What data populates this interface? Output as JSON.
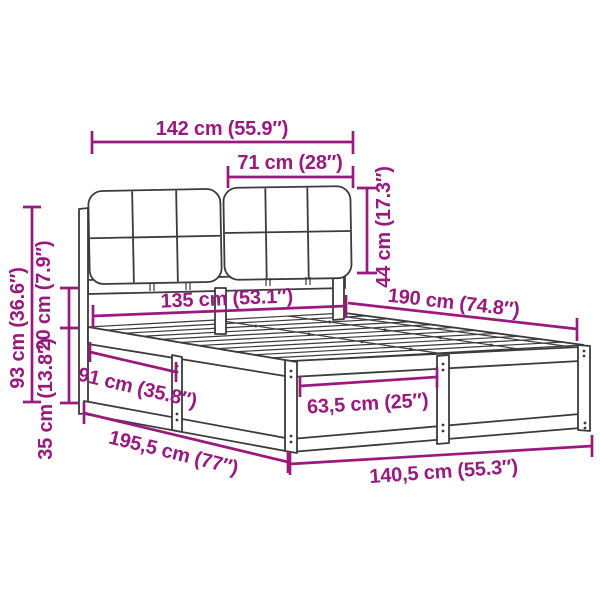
{
  "diagram": {
    "title": "bed-frame-with-upholstered-headboard-dimension-diagram",
    "colors": {
      "dimension": "#991a7e",
      "outline": "#3b3b3b",
      "background": "#ffffff"
    },
    "labels": {
      "headboard_width": "142 cm (55.9″)",
      "cushion_width": "71 cm (28″)",
      "cushion_height": "44 cm (17.3″)",
      "inner_width": "135 cm (53.1″)",
      "frame_length": "190 cm (74.8″)",
      "total_height": "93 cm (36.6″)",
      "rail_gap_height": "20 cm (7.9″)",
      "under_bed_clearance": "35 cm (13.8″)",
      "side_section_length": "91 cm (35.8″)",
      "total_length": "195,5 cm (77″)",
      "leg_spacing": "63,5 cm (25″)",
      "total_width": "140,5 cm (55.3″)"
    }
  }
}
